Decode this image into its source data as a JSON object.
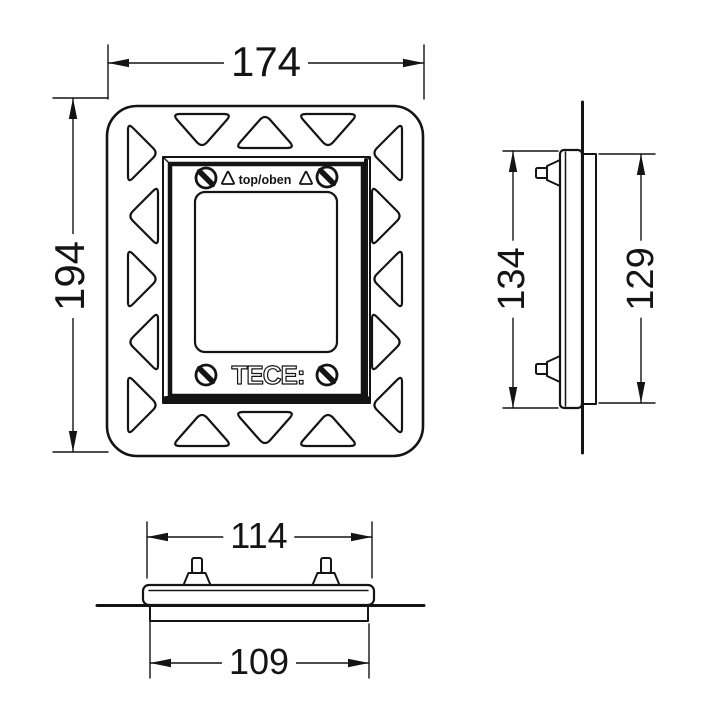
{
  "drawing": {
    "front_view": {
      "width_label": "174",
      "height_label": "194",
      "orientation_text": "top/oben",
      "brand_text": "TECE:"
    },
    "side_view": {
      "outer_height_label": "134",
      "inner_height_label": "129"
    },
    "bottom_view": {
      "outer_width_label": "114",
      "inner_width_label": "109"
    },
    "colors": {
      "line": "#141414",
      "background": "#ffffff"
    }
  }
}
